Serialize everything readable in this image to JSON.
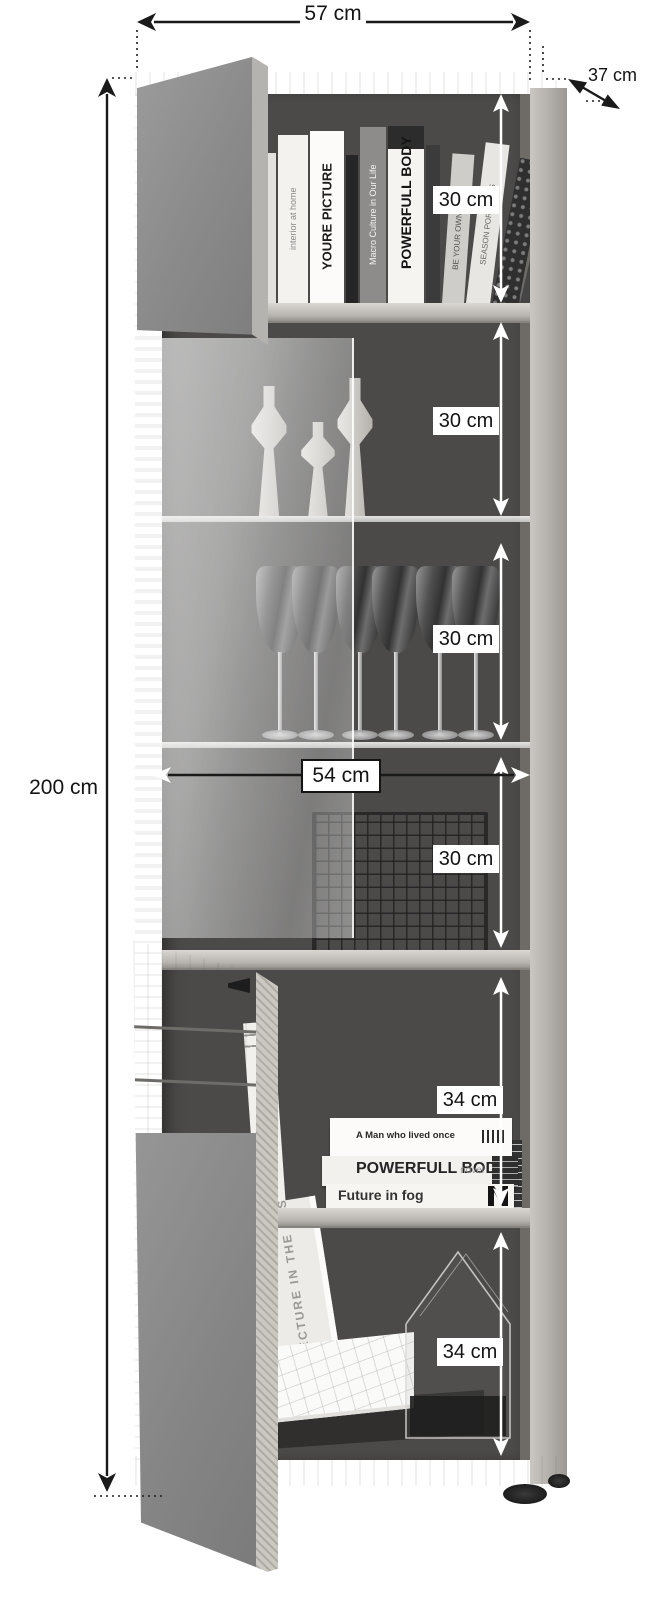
{
  "page": {
    "background_color": "#ffffff"
  },
  "diagram": {
    "subject": "Tall display cabinet (vitrine) with open doors – dimension drawing",
    "style": "grayscale product photo with dimension arrows",
    "annotations": {
      "overall_width": "57 cm",
      "overall_depth": "37 cm",
      "overall_height": "200 cm",
      "inner_width": "54 cm",
      "compartment_heights": [
        "30 cm",
        "30 cm",
        "30 cm",
        "30 cm",
        "34 cm",
        "34 cm"
      ]
    },
    "compartment_contents": [
      "books",
      "candle holders",
      "wine glasses",
      "wire basket",
      "books",
      "storage box and house-shaped frame"
    ],
    "top_books": [
      {
        "title": ""
      },
      {
        "title": "interior at home"
      },
      {
        "title": "YOURE PICTURE"
      },
      {
        "title": ""
      },
      {
        "title": "Macro Culture in Our Life"
      },
      {
        "title": "POWERFULL BODY"
      },
      {
        "title": ""
      },
      {
        "title": "BE YOUR OWN BOSS"
      },
      {
        "title": "SEASON PORTRAITS"
      },
      {
        "title": ""
      },
      {
        "title": ""
      }
    ],
    "bottom_books_vertical": [
      {
        "title": "new brand"
      },
      {
        "title": "ARCHITECTURE IN THE PAST"
      }
    ],
    "bottom_books_stacked": [
      {
        "title": "A Man who lived once",
        "subtitle": ""
      },
      {
        "title": "POWERFULL BODY",
        "subtitle": "novel"
      },
      {
        "title": "Future in fog",
        "subtitle": ""
      }
    ],
    "colors": {
      "wood": "#c6c3be",
      "interior_back": "#4b4a49",
      "door_gray": "#8f8f8f",
      "dimension_line": "#1a1a1a",
      "arrow_white": "#ffffff"
    }
  }
}
